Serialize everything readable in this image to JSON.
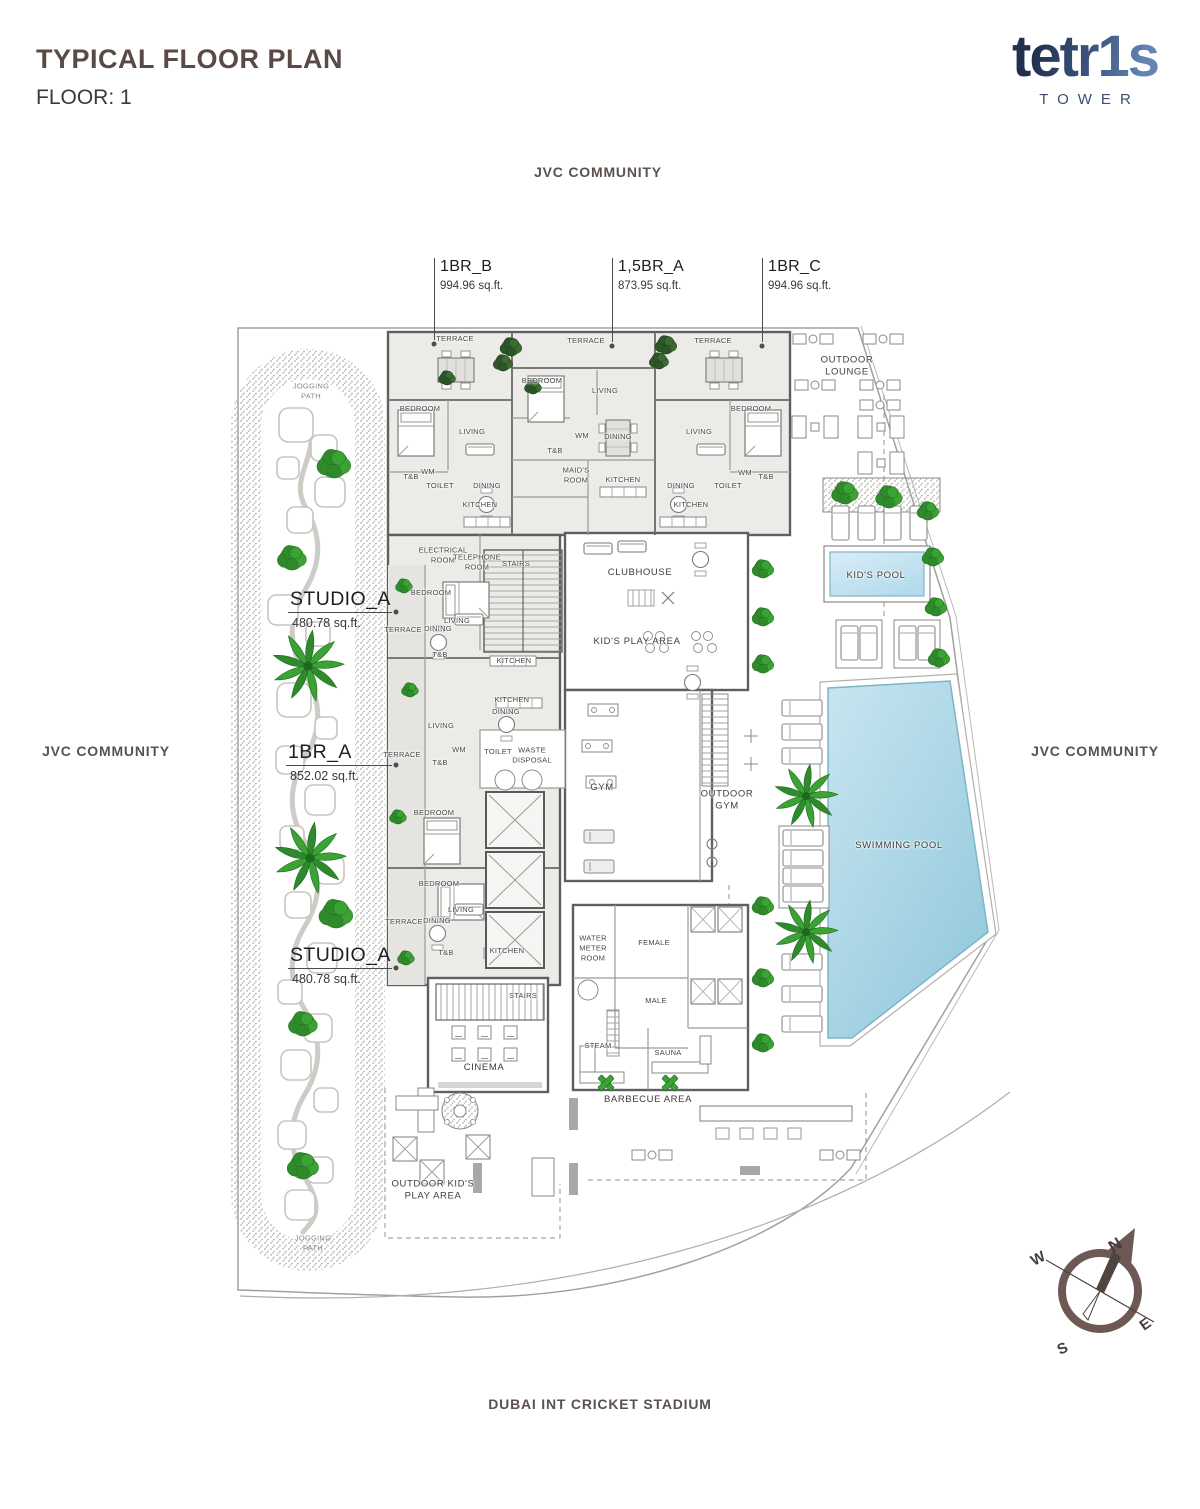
{
  "header": {
    "title": "TYPICAL FLOOR PLAN",
    "floor_label": "FLOOR: 1"
  },
  "logo": {
    "brand": "tetr1s",
    "subtitle": "TOWER"
  },
  "surroundings": {
    "top": "JVC COMMUNITY",
    "left": "JVC COMMUNITY",
    "right": "JVC COMMUNITY",
    "bottom": "DUBAI INT CRICKET STADIUM"
  },
  "compass": {
    "north": "N",
    "east": "E",
    "south": "S",
    "west": "W"
  },
  "colors": {
    "title_brown": "#594a46",
    "logo_navy": "#2c3a5c",
    "logo_light": "#6584b4",
    "pool_blue": "#9ccfe1",
    "kids_pool_blue": "#b9dded",
    "vegetation_green": "#3aa334",
    "compass_brown": "#6d5853",
    "unit_fill": "#ecebe8",
    "wall_gray": "#5f5f5f"
  },
  "plan": {
    "units": [
      {
        "name": "1BR_B",
        "area": "994.96 sq.ft.",
        "style": "top",
        "tx": 440,
        "ty": 258,
        "lx": 434,
        "ly1": 258,
        "ly2": 340
      },
      {
        "name": "1,5BR_A",
        "area": "873.95 sq.ft.",
        "style": "top",
        "tx": 618,
        "ty": 258,
        "lx": 612,
        "ly1": 258,
        "ly2": 342
      },
      {
        "name": "1BR_C",
        "area": "994.96 sq.ft.",
        "style": "top",
        "tx": 768,
        "ty": 258,
        "lx": 762,
        "ly1": 258,
        "ly2": 342
      },
      {
        "name": "STUDIO_A",
        "area": "480.78 sq.ft.",
        "style": "side",
        "tx": 290,
        "ty": 588,
        "lx1": 288,
        "lx2": 392,
        "ly": 612,
        "ax": 292,
        "ay": 616
      },
      {
        "name": "1BR_A",
        "area": "852.02 sq.ft.",
        "style": "side",
        "tx": 288,
        "ty": 741,
        "lx1": 286,
        "lx2": 392,
        "ly": 765,
        "ax": 290,
        "ay": 769
      },
      {
        "name": "STUDIO_A",
        "area": "480.78 sq.ft.",
        "style": "side",
        "tx": 290,
        "ty": 944,
        "lx1": 288,
        "lx2": 392,
        "ly": 968,
        "ax": 292,
        "ay": 972
      }
    ],
    "rooms": [
      {
        "label": "TERRACE",
        "x": 455,
        "y": 339
      },
      {
        "label": "TERRACE",
        "x": 586,
        "y": 341
      },
      {
        "label": "TERRACE",
        "x": 713,
        "y": 341
      },
      {
        "label": "BEDROOM",
        "x": 420,
        "y": 409
      },
      {
        "label": "BEDROOM",
        "x": 542,
        "y": 381
      },
      {
        "label": "BEDROOM",
        "x": 751,
        "y": 409
      },
      {
        "label": "LIVING",
        "x": 472,
        "y": 432
      },
      {
        "label": "LIVING",
        "x": 605,
        "y": 391
      },
      {
        "label": "LIVING",
        "x": 699,
        "y": 432
      },
      {
        "label": "DINING",
        "x": 487,
        "y": 486
      },
      {
        "label": "DINING",
        "x": 618,
        "y": 437
      },
      {
        "label": "DINING",
        "x": 681,
        "y": 486
      },
      {
        "label": "KITCHEN",
        "x": 480,
        "y": 505
      },
      {
        "label": "KITCHEN",
        "x": 623,
        "y": 480
      },
      {
        "label": "KITCHEN",
        "x": 691,
        "y": 505
      },
      {
        "label": "TOILET",
        "x": 440,
        "y": 486
      },
      {
        "label": "TOILET",
        "x": 728,
        "y": 486
      },
      {
        "label": "T&B",
        "x": 411,
        "y": 477
      },
      {
        "label": "T&B",
        "x": 555,
        "y": 451
      },
      {
        "label": "T&B",
        "x": 766,
        "y": 477
      },
      {
        "label": "WM",
        "x": 428,
        "y": 472
      },
      {
        "label": "WM",
        "x": 582,
        "y": 436
      },
      {
        "label": "WM",
        "x": 745,
        "y": 473
      },
      {
        "label": "MAID'S\nROOM",
        "x": 576,
        "y": 475
      },
      {
        "label": "ELECTRICAL\nROOM",
        "x": 443,
        "y": 555
      },
      {
        "label": "TELEPHONE\nROOM",
        "x": 477,
        "y": 562
      },
      {
        "label": "STAIRS",
        "x": 516,
        "y": 564
      },
      {
        "label": "BEDROOM",
        "x": 431,
        "y": 593
      },
      {
        "label": "LIVING",
        "x": 457,
        "y": 621
      },
      {
        "label": "DINING",
        "x": 438,
        "y": 629
      },
      {
        "label": "TERRACE",
        "x": 403,
        "y": 630
      },
      {
        "label": "T&B",
        "x": 440,
        "y": 655
      },
      {
        "label": "KITCHEN",
        "x": 514,
        "y": 661
      },
      {
        "label": "KITCHEN",
        "x": 512,
        "y": 700
      },
      {
        "label": "DINING",
        "x": 506,
        "y": 712
      },
      {
        "label": "LIVING",
        "x": 441,
        "y": 726
      },
      {
        "label": "WM",
        "x": 459,
        "y": 750
      },
      {
        "label": "TOILET",
        "x": 498,
        "y": 752
      },
      {
        "label": "WASTE\nDISPOSAL",
        "x": 532,
        "y": 755
      },
      {
        "label": "TERRACE",
        "x": 402,
        "y": 755
      },
      {
        "label": "T&B",
        "x": 440,
        "y": 763
      },
      {
        "label": "BEDROOM",
        "x": 434,
        "y": 813
      },
      {
        "label": "BEDROOM",
        "x": 439,
        "y": 884
      },
      {
        "label": "LIVING",
        "x": 461,
        "y": 910
      },
      {
        "label": "DINING",
        "x": 437,
        "y": 921
      },
      {
        "label": "TERRACE",
        "x": 404,
        "y": 922
      },
      {
        "label": "T&B",
        "x": 446,
        "y": 953
      },
      {
        "label": "KITCHEN",
        "x": 507,
        "y": 951
      },
      {
        "label": "STAIRS",
        "x": 523,
        "y": 996
      },
      {
        "label": "CLUBHOUSE",
        "x": 640,
        "y": 573,
        "s": "md"
      },
      {
        "label": "KID'S PLAY AREA",
        "x": 637,
        "y": 642,
        "s": "md"
      },
      {
        "label": "GYM",
        "x": 602,
        "y": 788,
        "s": "md"
      },
      {
        "label": "OUTDOOR\nGYM",
        "x": 727,
        "y": 801,
        "s": "md"
      },
      {
        "label": "WATER\nMETER\nROOM",
        "x": 593,
        "y": 948
      },
      {
        "label": "FEMALE",
        "x": 654,
        "y": 943
      },
      {
        "label": "MALE",
        "x": 656,
        "y": 1001
      },
      {
        "label": "STEAM",
        "x": 598,
        "y": 1046
      },
      {
        "label": "SAUNA",
        "x": 668,
        "y": 1053
      },
      {
        "label": "CINEMA",
        "x": 484,
        "y": 1068,
        "s": "md"
      },
      {
        "label": "BARBECUE AREA",
        "x": 648,
        "y": 1100,
        "s": "md"
      },
      {
        "label": "OUTDOOR KID'S\nPLAY AREA",
        "x": 433,
        "y": 1191,
        "s": "md"
      },
      {
        "label": "OUTDOOR\nLOUNGE",
        "x": 847,
        "y": 367,
        "s": "md"
      },
      {
        "label": "KID'S POOL",
        "x": 876,
        "y": 576,
        "s": "md"
      },
      {
        "label": "SWIMMING POOL",
        "x": 899,
        "y": 846,
        "s": "md"
      },
      {
        "label": "JOGGING\nPATH",
        "x": 311,
        "y": 391,
        "s": "gray"
      },
      {
        "label": "JOGGING\nPATH",
        "x": 313,
        "y": 1243,
        "s": "gray"
      }
    ],
    "vegetation": [
      {
        "t": "palm",
        "x": 308,
        "y": 666,
        "r": 36
      },
      {
        "t": "palm",
        "x": 310,
        "y": 858,
        "r": 36
      },
      {
        "t": "palm",
        "x": 806,
        "y": 796,
        "r": 32
      },
      {
        "t": "palm",
        "x": 806,
        "y": 932,
        "r": 32
      },
      {
        "t": "bush",
        "x": 334,
        "y": 464,
        "r": 14
      },
      {
        "t": "bush",
        "x": 292,
        "y": 558,
        "r": 12
      },
      {
        "t": "bush",
        "x": 336,
        "y": 914,
        "r": 14
      },
      {
        "t": "bush",
        "x": 303,
        "y": 1024,
        "r": 12
      },
      {
        "t": "bush",
        "x": 303,
        "y": 1166,
        "r": 13
      },
      {
        "t": "bush",
        "x": 845,
        "y": 493,
        "r": 11
      },
      {
        "t": "bush",
        "x": 889,
        "y": 497,
        "r": 11
      },
      {
        "t": "bush",
        "x": 928,
        "y": 511,
        "r": 9
      },
      {
        "t": "bush",
        "x": 933,
        "y": 557,
        "r": 9
      },
      {
        "t": "bush",
        "x": 936,
        "y": 607,
        "r": 9
      },
      {
        "t": "bush",
        "x": 939,
        "y": 658,
        "r": 9
      },
      {
        "t": "bush",
        "x": 763,
        "y": 569,
        "r": 9
      },
      {
        "t": "bush",
        "x": 763,
        "y": 617,
        "r": 9
      },
      {
        "t": "bush",
        "x": 763,
        "y": 664,
        "r": 9
      },
      {
        "t": "bush",
        "x": 763,
        "y": 906,
        "r": 9
      },
      {
        "t": "bush",
        "x": 763,
        "y": 978,
        "r": 9
      },
      {
        "t": "bush",
        "x": 763,
        "y": 1043,
        "r": 9
      },
      {
        "t": "bush",
        "x": 404,
        "y": 586,
        "r": 7
      },
      {
        "t": "bush",
        "x": 410,
        "y": 690,
        "r": 7
      },
      {
        "t": "bush",
        "x": 398,
        "y": 817,
        "r": 7
      },
      {
        "t": "bush",
        "x": 406,
        "y": 958,
        "r": 7
      },
      {
        "t": "dark",
        "x": 511,
        "y": 347,
        "r": 9
      },
      {
        "t": "dark",
        "x": 503,
        "y": 363,
        "r": 8
      },
      {
        "t": "dark",
        "x": 666,
        "y": 345,
        "r": 9
      },
      {
        "t": "dark",
        "x": 659,
        "y": 361,
        "r": 8
      },
      {
        "t": "dark",
        "x": 447,
        "y": 378,
        "r": 7
      },
      {
        "t": "dark",
        "x": 533,
        "y": 387,
        "r": 7
      },
      {
        "t": "cross",
        "x": 606,
        "y": 1083,
        "r": 9
      },
      {
        "t": "cross",
        "x": 670,
        "y": 1083,
        "r": 9
      }
    ]
  }
}
